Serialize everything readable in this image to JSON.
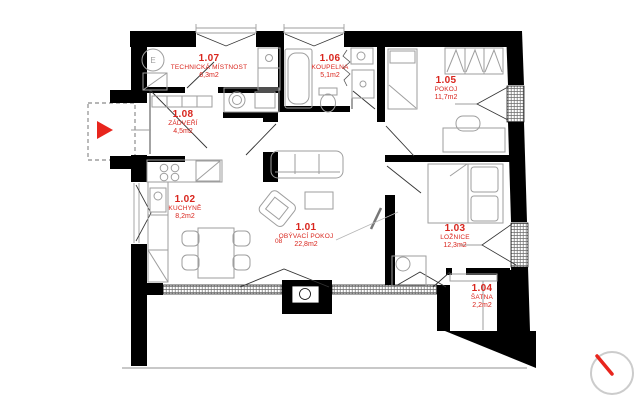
{
  "document": {
    "type": "architectural floor plan"
  },
  "colors": {
    "label_red": "#d9251d",
    "entrance_arrow_red": "#e8251d",
    "compass_needle_red": "#e8251d",
    "wall_black": "#000000",
    "furniture_gray": "#9e9e9e"
  },
  "rooms": [
    {
      "id": "1.07",
      "name": "TECHNICKÁ MÍSTNOST",
      "area": "6,3m2"
    },
    {
      "id": "1.06",
      "name": "KOUPELNA",
      "area": "5,1m2"
    },
    {
      "id": "1.05",
      "name": "POKOJ",
      "area": "11,7m2"
    },
    {
      "id": "1.08",
      "name": "ZÁDVEŘÍ",
      "area": "4,5m2"
    },
    {
      "id": "1.02",
      "name": "KUCHYNĚ",
      "area": "8,2m2"
    },
    {
      "id": "1.01",
      "name": "OBÝVACÍ POKOJ",
      "area": "22,8m2"
    },
    {
      "id": "1.03",
      "name": "LOŽNICE",
      "area": "12,3m2"
    },
    {
      "id": "1.04",
      "name": "ŠATNA",
      "area": "2,2m2"
    }
  ],
  "annotations": {
    "door_label": "08",
    "electric_meter": "E"
  },
  "icons": {
    "compass": "compass-icon",
    "entrance": "entrance-arrow-icon"
  }
}
